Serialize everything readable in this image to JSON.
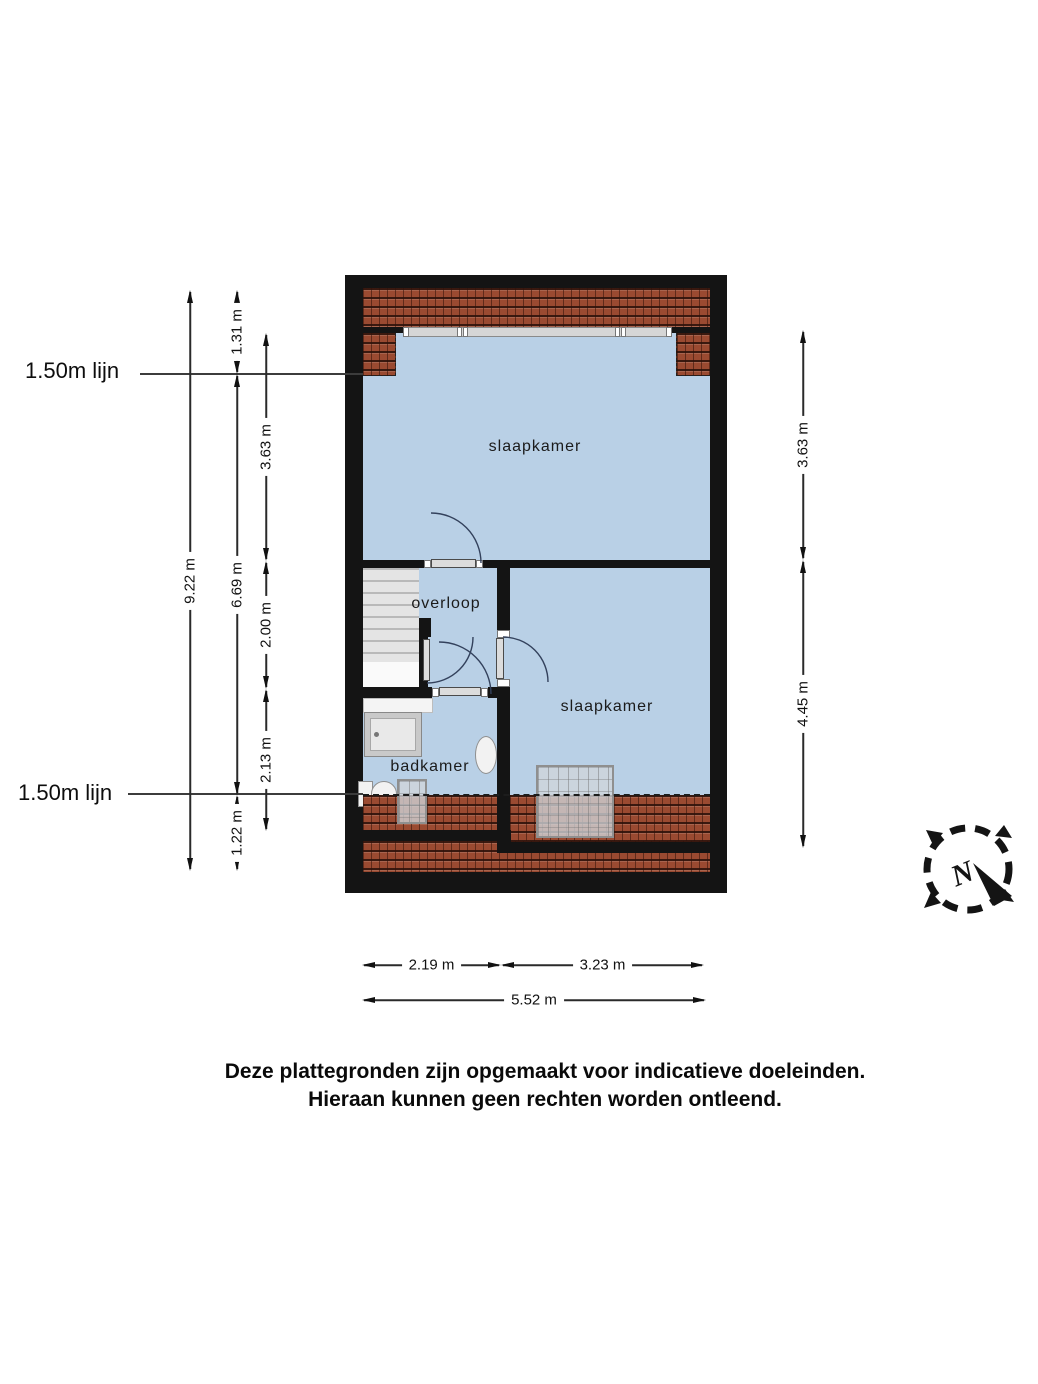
{
  "plan": {
    "rooms": [
      {
        "id": "bedroom-top",
        "label": "slaapkamer"
      },
      {
        "id": "landing",
        "label": "overloop"
      },
      {
        "id": "bathroom",
        "label": "badkamer"
      },
      {
        "id": "bedroom-bottom",
        "label": "slaapkamer"
      }
    ],
    "height_lines": [
      {
        "label": "1.50m lijn"
      },
      {
        "label": "1.50m lijn"
      }
    ],
    "dims": {
      "left": [
        {
          "label": "9.22 m"
        },
        {
          "label": "1.31 m"
        },
        {
          "label": "6.69 m"
        },
        {
          "label": "1.22 m"
        },
        {
          "label": "3.63 m"
        },
        {
          "label": "2.00 m"
        },
        {
          "label": "2.13 m"
        }
      ],
      "right": [
        {
          "label": "3.63 m"
        },
        {
          "label": "4.45 m"
        }
      ],
      "bottom": [
        {
          "label": "2.19 m"
        },
        {
          "label": "3.23 m"
        },
        {
          "label": "5.52 m"
        }
      ]
    },
    "compass": {
      "north_label": "N"
    },
    "colors": {
      "room_fill": "#b9d0e6",
      "roof_tile": "#9a4a31",
      "wall": "#141414",
      "stairs": "#e4e4e4"
    }
  },
  "footer": {
    "line1": "Deze plattegronden zijn opgemaakt voor indicatieve doeleinden.",
    "line2": "Hieraan kunnen geen rechten worden ontleend."
  }
}
